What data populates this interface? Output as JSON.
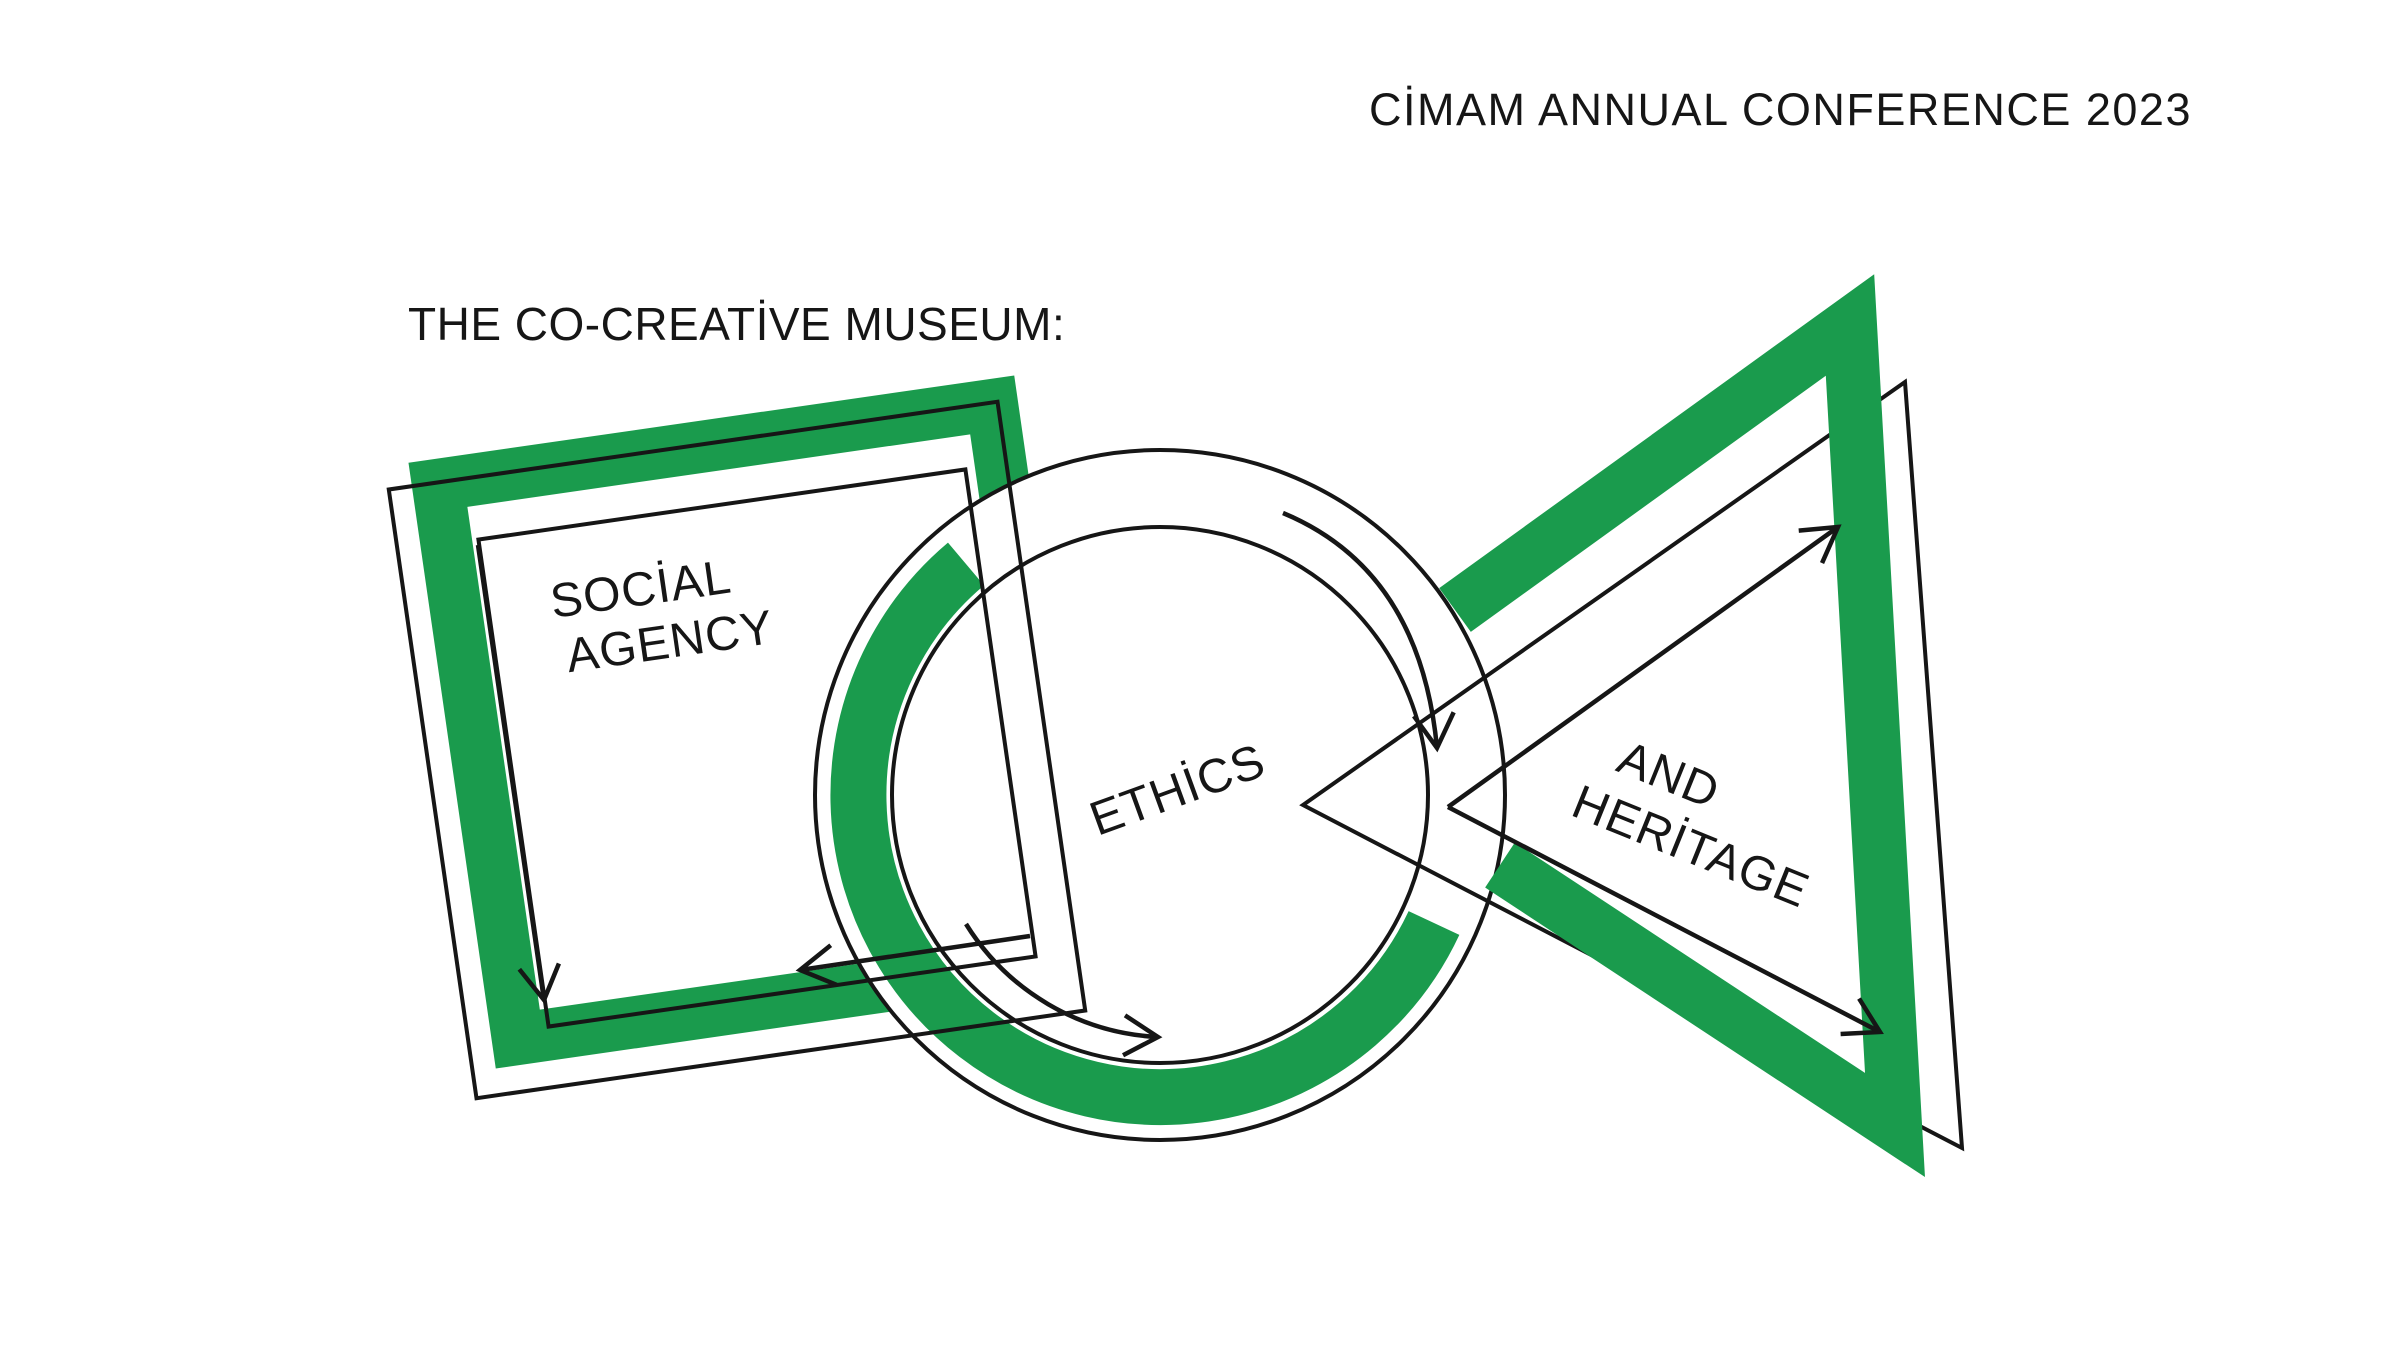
{
  "header": {
    "conference_title": "CİMAM ANNUAL CONFERENCE 2023"
  },
  "main": {
    "page_title": "THE CO-CREATİVE MUSEUM:",
    "shapes": {
      "square": {
        "label_line1": "SOCİAL",
        "label_line2": "AGENCY"
      },
      "circle": {
        "label": "ETHİCS"
      },
      "triangle": {
        "label_line1": "AND",
        "label_line2": "HERİTAGE"
      }
    }
  },
  "colors": {
    "accent_green": "#1A9B4D",
    "ink": "#161616",
    "background": "#FFFFFF"
  }
}
